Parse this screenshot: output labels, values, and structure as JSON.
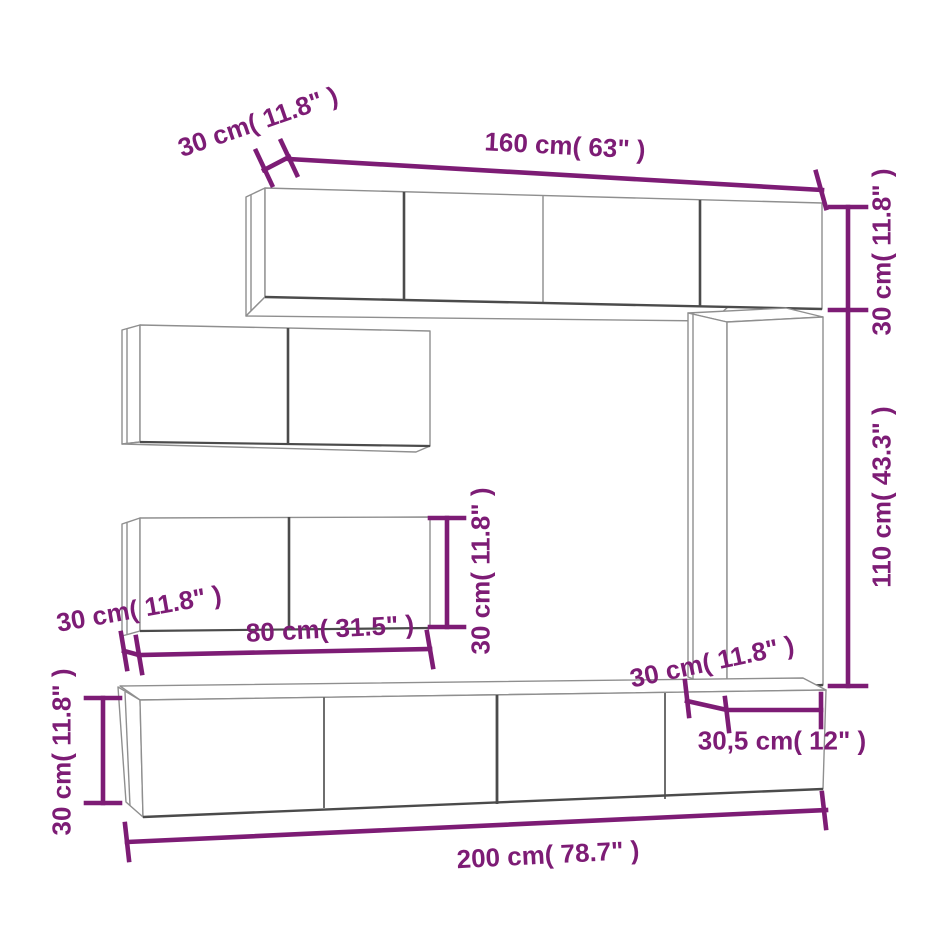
{
  "image": {
    "background_color": "#ffffff",
    "accent_color": "#7d1c75",
    "outline_color": "#8f8f8f",
    "outline_dark_color": "#4b4b4b",
    "subject": "wall-mounted TV cabinet set dimension diagram"
  },
  "dimensions": [
    {
      "id": "top-cabinet-depth",
      "text": "30 cm( 11.8\" )"
    },
    {
      "id": "top-cabinet-width",
      "text": "160 cm( 63\" )"
    },
    {
      "id": "top-cabinet-height",
      "text": "30 cm( 11.8\" )"
    },
    {
      "id": "tall-cabinet-height",
      "text": "110 cm( 43.3\" )"
    },
    {
      "id": "left-cabinet-height",
      "text": "30 cm( 11.8\" )"
    },
    {
      "id": "left-cabinet-depth",
      "text": "30 cm( 11.8\" )"
    },
    {
      "id": "left-cabinet-width",
      "text": "80 cm( 31.5\" )"
    },
    {
      "id": "tall-cabinet-depth",
      "text": "30 cm( 11.8\" )"
    },
    {
      "id": "tall-cabinet-width",
      "text": "30,5 cm( 12\" )"
    },
    {
      "id": "tv-bench-height",
      "text": "30 cm( 11.8\" )"
    },
    {
      "id": "tv-bench-width",
      "text": "200 cm( 78.7\" )"
    }
  ]
}
